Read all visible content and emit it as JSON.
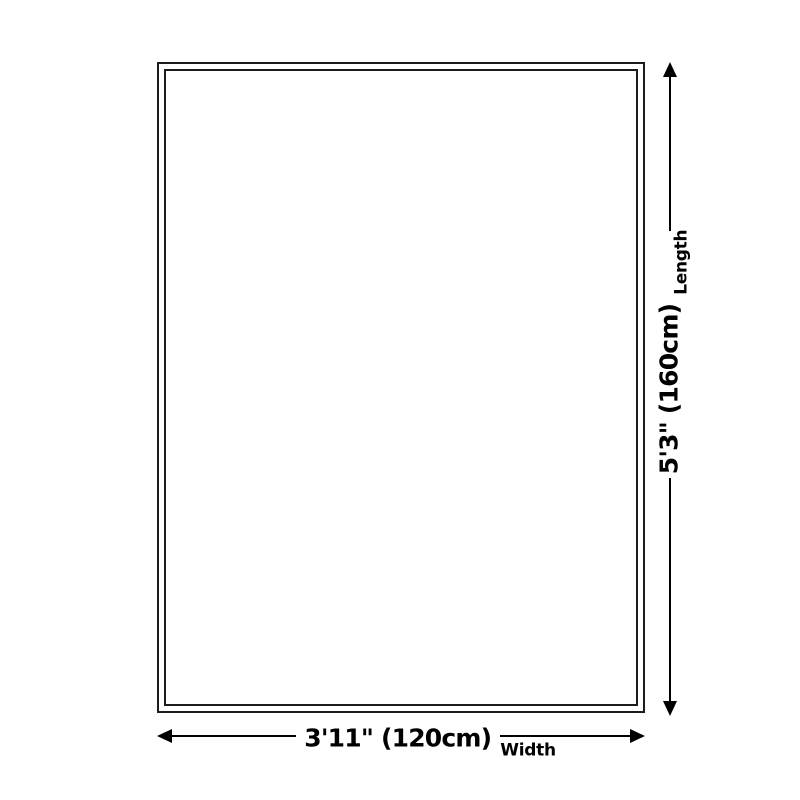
{
  "diagram": {
    "type": "product-dimension-diagram",
    "colors": {
      "background": "#ffffff",
      "outline": "#1c1c1c",
      "dimension": "#000000"
    },
    "dimensions": {
      "length": {
        "value": "5'3\" (160cm)",
        "label": "Length"
      },
      "width": {
        "value": "3'11\" (120cm)",
        "label": "Width"
      }
    }
  }
}
